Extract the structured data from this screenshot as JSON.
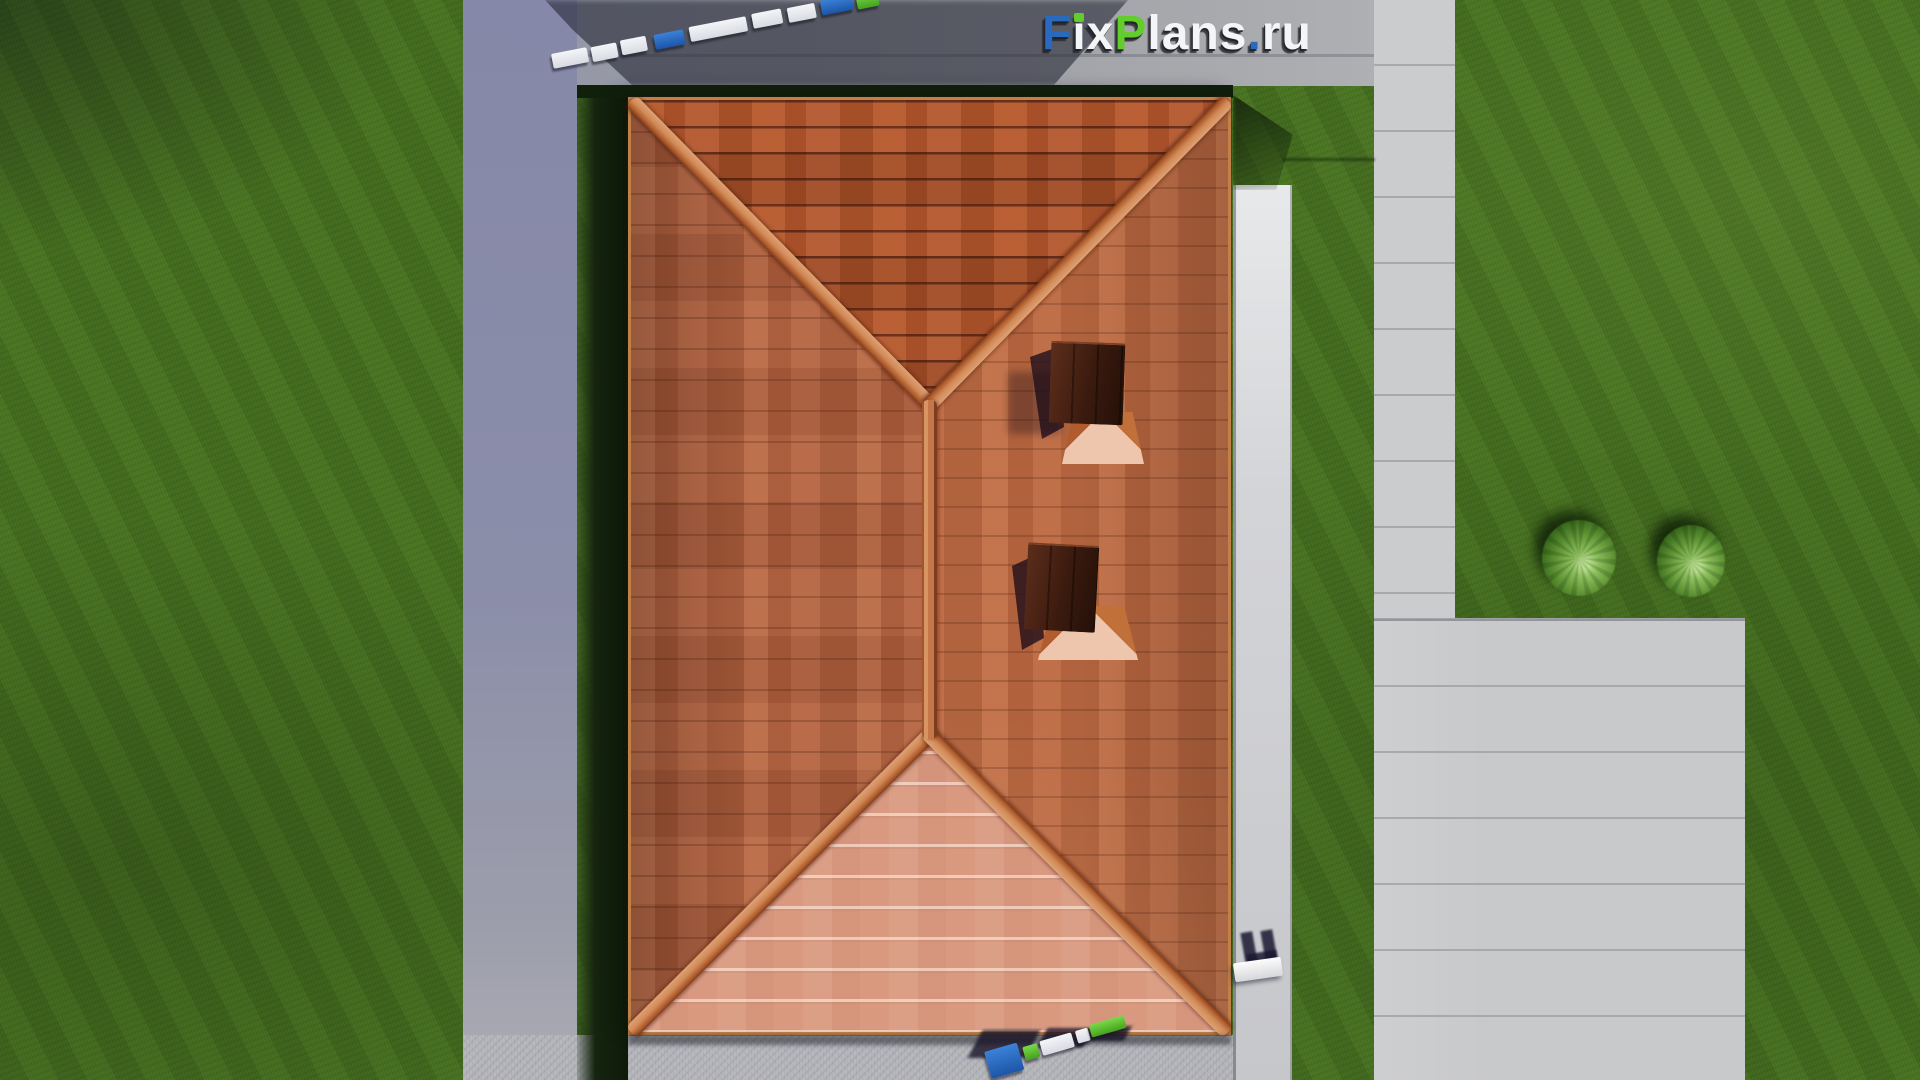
{
  "watermark": {
    "text": "FixPlans.ru",
    "letters": [
      {
        "char": "F",
        "color": "#2a6abe"
      },
      {
        "char": "i",
        "color": "#f4f5f7",
        "dot_color": "#63cd2c"
      },
      {
        "char": "x",
        "color": "#f4f5f7"
      },
      {
        "char": "P",
        "color": "#63cd2c"
      },
      {
        "char": "l",
        "color": "#f4f5f7"
      },
      {
        "char": "a",
        "color": "#f4f5f7"
      },
      {
        "char": "n",
        "color": "#f4f5f7"
      },
      {
        "char": "s",
        "color": "#f4f5f7"
      },
      {
        "char": ".",
        "color": "#2a6abe"
      },
      {
        "char": "r",
        "color": "#f4f5f7"
      },
      {
        "char": "u",
        "color": "#f4f5f7"
      }
    ]
  },
  "scene": {
    "view": "top-down aerial render of a house with hipped terracotta tile roof",
    "objects": [
      "lawn",
      "paved-courtyard",
      "stone-walkway",
      "driveway-slabs",
      "hip-roof",
      "chimney-1",
      "chimney-2",
      "roof-pyramid-flashing",
      "bench",
      "bush-1",
      "bush-2",
      "folding-ruler-top",
      "folding-ruler-bottom"
    ],
    "palette": {
      "grass": "#46701f",
      "pavement_shaded": "#8b8ea9",
      "pavement_lit": "#c9cacc",
      "stone_walkway": "#d9dadd",
      "roof_tile_north": "#ad5128",
      "roof_tile_west": "#b2603d",
      "roof_tile_east": "#bd6a42",
      "roof_tile_south": "#cc7e61",
      "ridge_cap": "#d08a58",
      "chimney": "#3a1a0e",
      "prop_blue": "#2e7fd0",
      "prop_green": "#5fc62e",
      "prop_white": "#eef0f3"
    }
  }
}
